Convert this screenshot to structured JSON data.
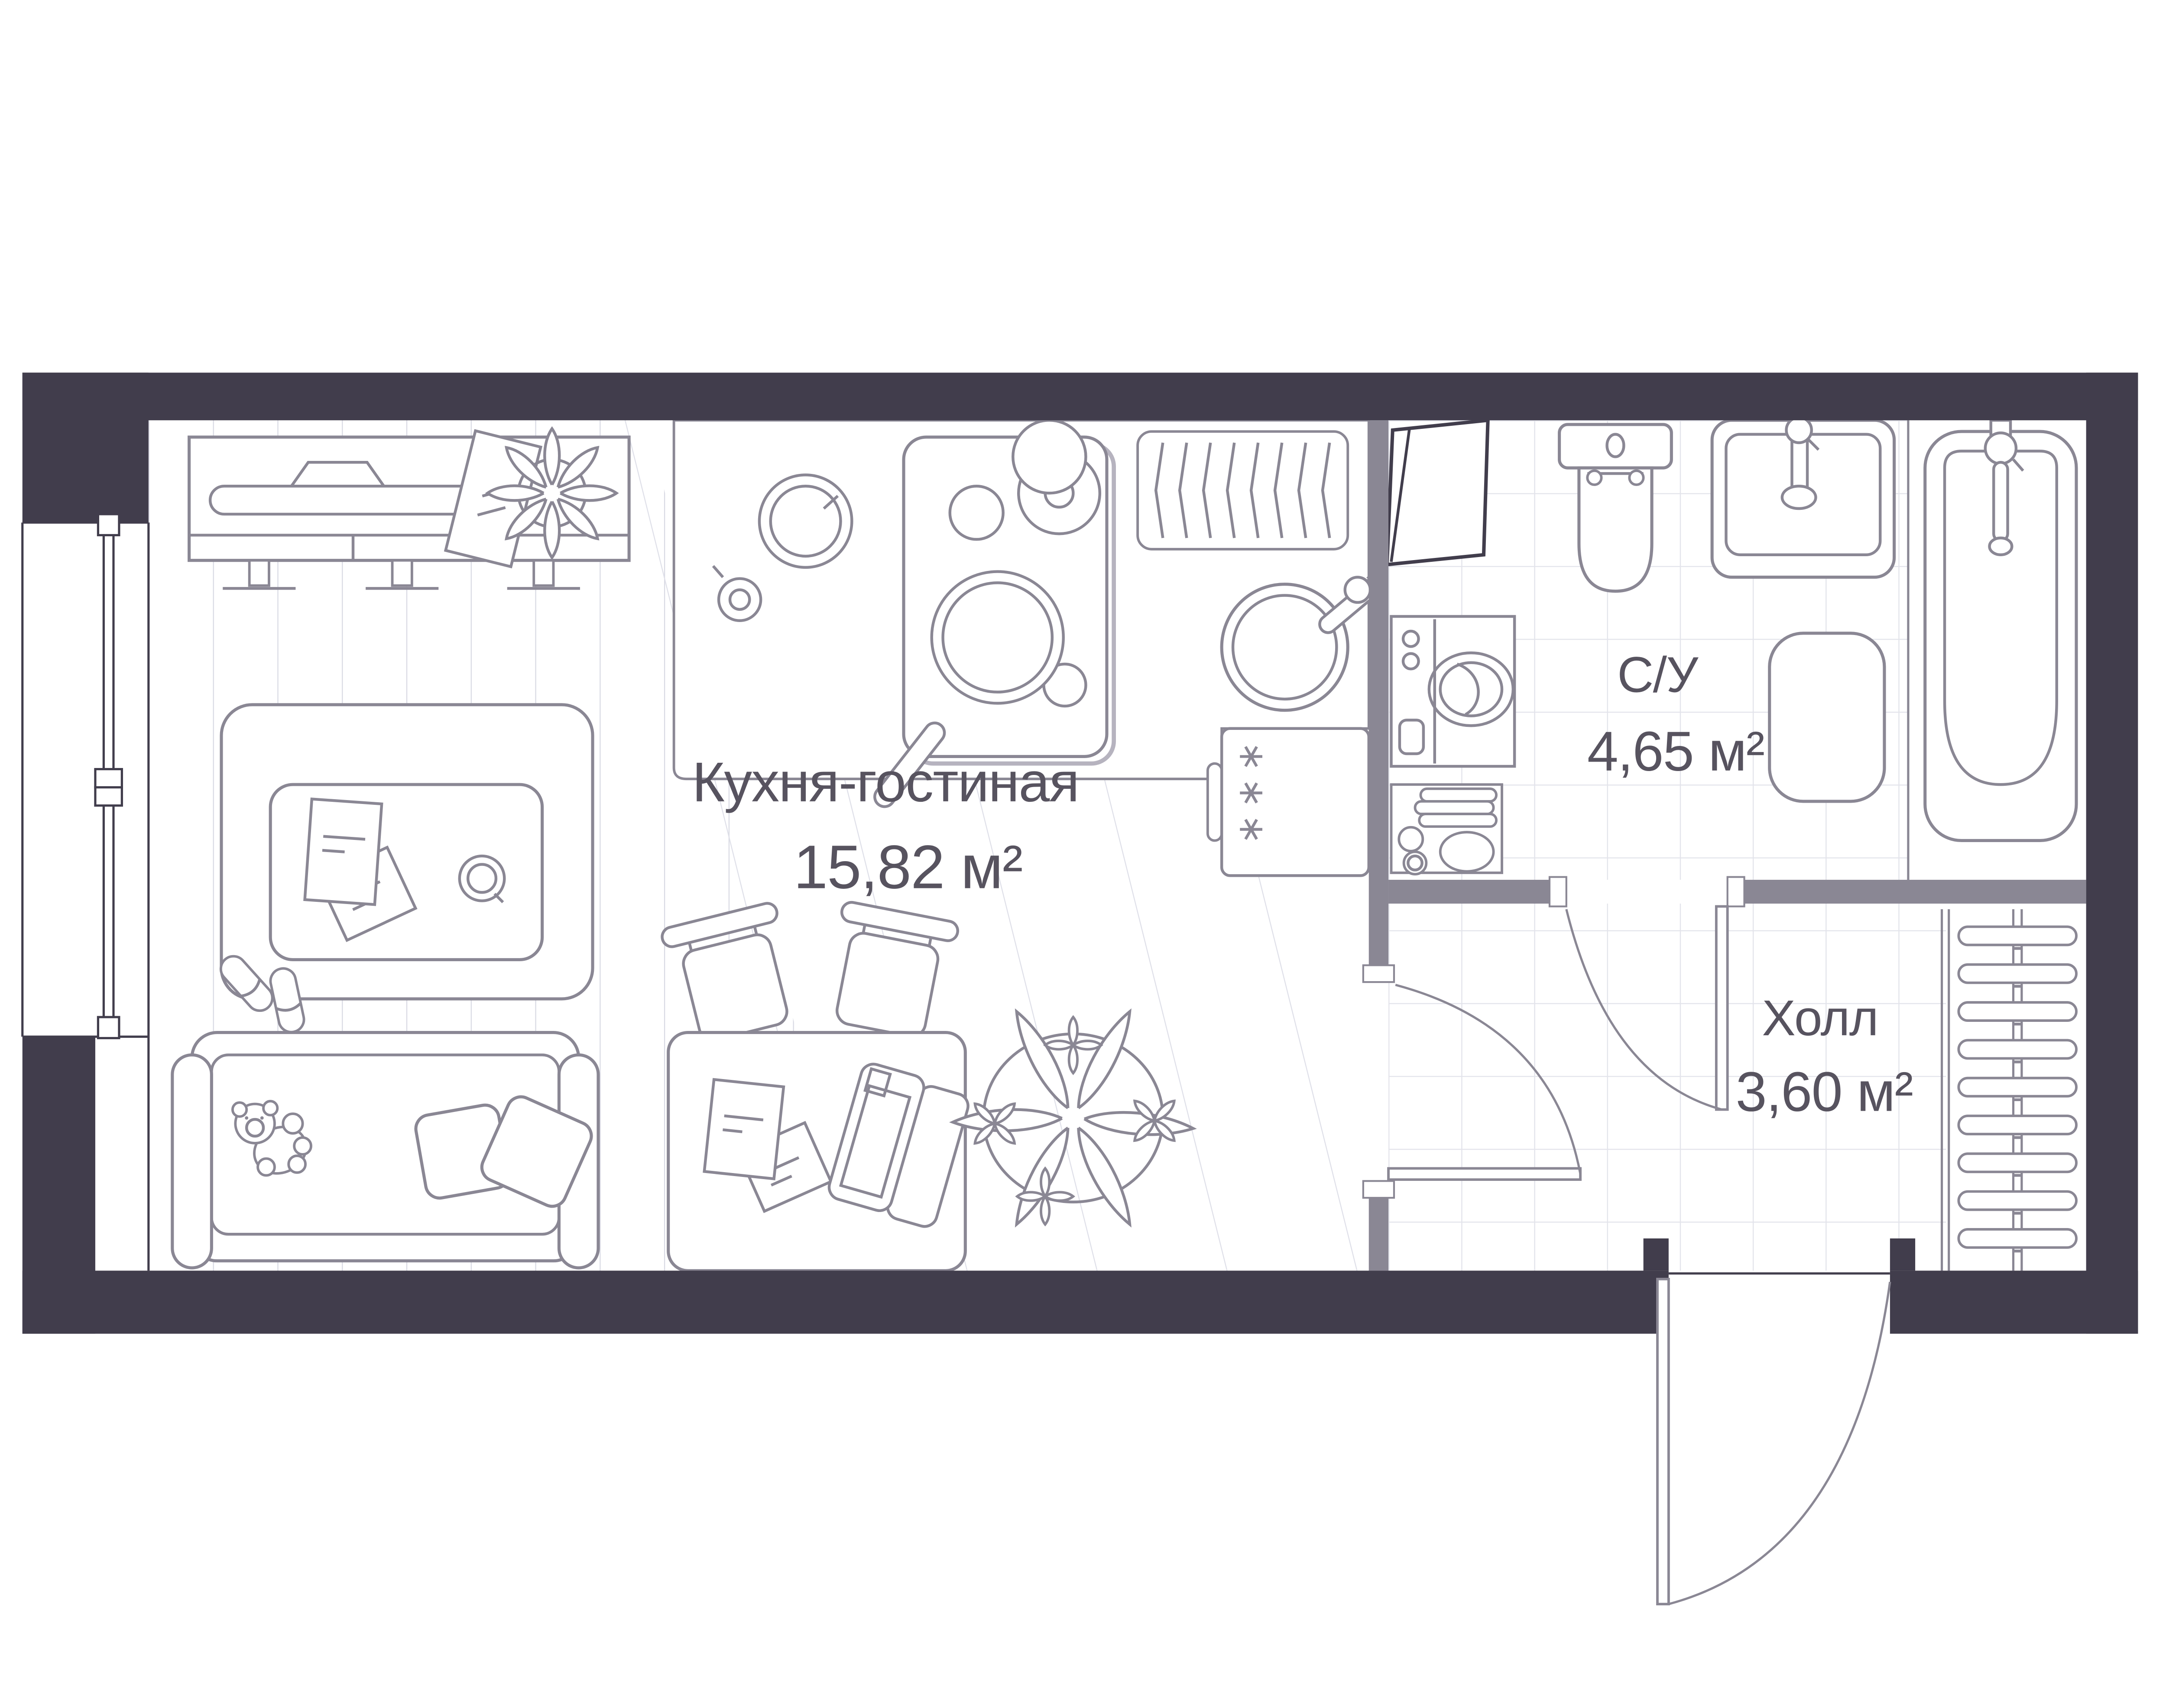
{
  "floorplan": {
    "rooms": [
      {
        "id": "kitchen-living",
        "name": "Кухня-гостиная",
        "area": "15,82 м²"
      },
      {
        "id": "bathroom",
        "name": "С/У",
        "area": "4,65 м²"
      },
      {
        "id": "hall",
        "name": "Холл",
        "area": "3,60 м²"
      }
    ],
    "colors": {
      "outer_wall": "#413D4C",
      "inner_wall": "#8A8794",
      "furniture_line": "#8A8794",
      "plank_line": "#D8D9E3",
      "hatch_line": "#DEDFE8",
      "tile_line": "#E3E4EB",
      "label_text": "#57535F",
      "background": "#FFFFFF"
    },
    "icons": [
      "window-icon",
      "tv-console-icon",
      "picture-frame-icon",
      "plant-icon",
      "rug-icon",
      "coffee-table-icon",
      "papers-icon",
      "cup-icon",
      "slippers-icon",
      "sofa-icon",
      "teddy-bear-icon",
      "pillow-icon",
      "dining-table-icon",
      "chair-icon",
      "laptop-icon",
      "big-plant-icon",
      "kitchen-counter-icon",
      "cooktop-icon",
      "pan-icon",
      "pot-icon",
      "plate-icon",
      "radiator-icon",
      "kitchen-sink-icon",
      "fridge-icon",
      "electric-panel-icon",
      "washing-machine-icon",
      "towel-shelf-icon",
      "toilet-icon",
      "washbasin-icon",
      "bath-mat-icon",
      "bathtub-icon",
      "wardrobe-hangers-icon",
      "door-swing-icon",
      "entrance-door-icon"
    ]
  }
}
